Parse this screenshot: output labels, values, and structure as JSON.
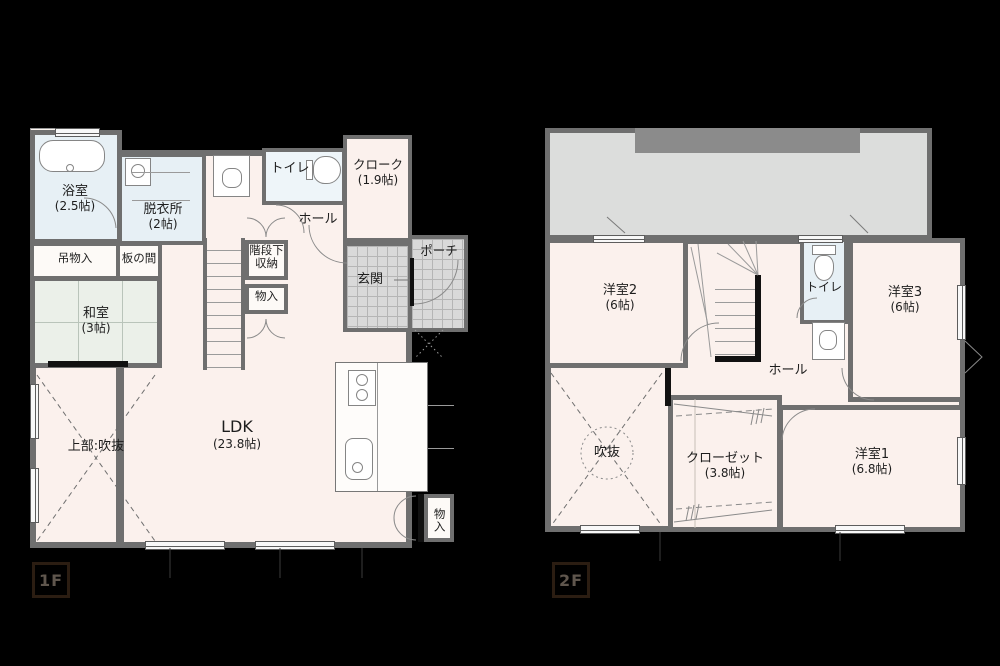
{
  "floor1": {
    "tag": "1F",
    "rooms": {
      "bath": {
        "name": "浴室",
        "size": "(2.5帖)"
      },
      "dressing": {
        "name": "脱衣所",
        "size": "(2帖)"
      },
      "toilet": {
        "name": "トイレ"
      },
      "cloak": {
        "name": "クローク",
        "size": "(1.9帖)"
      },
      "hall": {
        "name": "ホール"
      },
      "hanging_storage": {
        "name": "吊物入"
      },
      "board_room": {
        "name": "板の間"
      },
      "japanese_room": {
        "name": "和室",
        "size": "(3帖)"
      },
      "under_stair_storage": {
        "name": "階段下収納"
      },
      "storage_hall": {
        "name": "物入"
      },
      "entrance": {
        "name": "玄関"
      },
      "porch": {
        "name": "ポーチ"
      },
      "void_above": {
        "name": "上部:吹抜"
      },
      "ldk": {
        "name": "LDK",
        "size": "(23.8帖)"
      },
      "storage_kitchen": {
        "name": "物入"
      }
    }
  },
  "floor2": {
    "tag": "2F",
    "rooms": {
      "western_room2": {
        "name": "洋室2",
        "size": "(6帖)"
      },
      "toilet": {
        "name": "トイレ"
      },
      "western_room3": {
        "name": "洋室3",
        "size": "(6帖)"
      },
      "hall": {
        "name": "ホール"
      },
      "void": {
        "name": "吹抜"
      },
      "closet": {
        "name": "クローゼット",
        "size": "(3.8帖)"
      },
      "western_room1": {
        "name": "洋室1",
        "size": "(6.8帖)"
      }
    }
  },
  "colors": {
    "background": "#000000",
    "wall": "#6f6f6f",
    "floor": "#fbf1ed",
    "wet_area": "#e7f0f5",
    "tatami": "#ebf0e9",
    "tile": "#d9d9d9",
    "roof": "#dcdddc",
    "roof_band": "#8b8b8b",
    "text": "#1d1d1d",
    "floor_tag": "#5f564d"
  }
}
